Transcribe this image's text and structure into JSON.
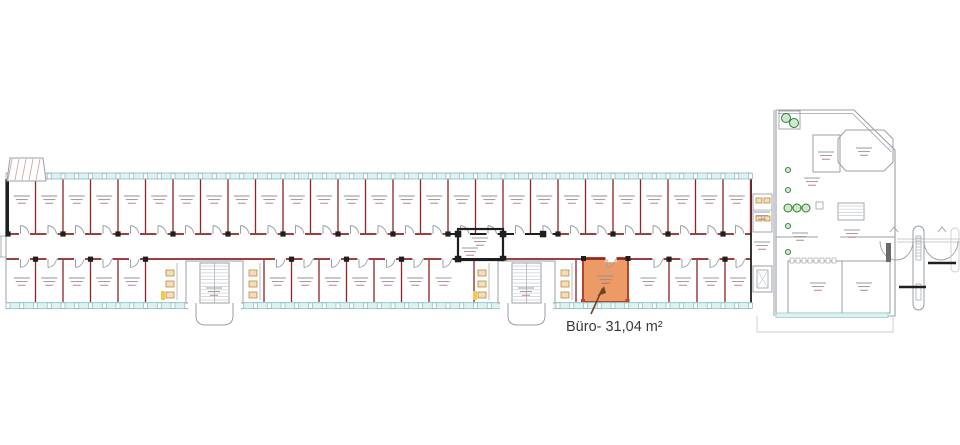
{
  "annotation": {
    "room_label": "Büro- 31,04 m²"
  },
  "highlight": {
    "room_name": "Büro",
    "area_m2": "31,04",
    "fill": "#EC9A66",
    "border": "#B3442E"
  },
  "colors": {
    "background": "#FFFFFF",
    "wall_red": "#8E2424",
    "wall_black": "#1F1F1F",
    "wall_gray": "#9AA0A5",
    "wall_light": "#C9CED2",
    "window_fill": "#DFF1F3",
    "window_stroke": "#96CCD2",
    "mullion_stroke": "#8FB6BA",
    "plant_green": "#2E7D32",
    "plant_fill": "#CFE8CF",
    "fixture_orange": "#C08A3E",
    "fixture_fill": "#F3DEBC",
    "accent_yellow": "#F5C84C",
    "hatch_pink": "#D4A7A7",
    "arrow": "#6E4428",
    "label_text": "#3A3A3A",
    "room_text": "#909090",
    "room_text_red": "#B06868"
  }
}
